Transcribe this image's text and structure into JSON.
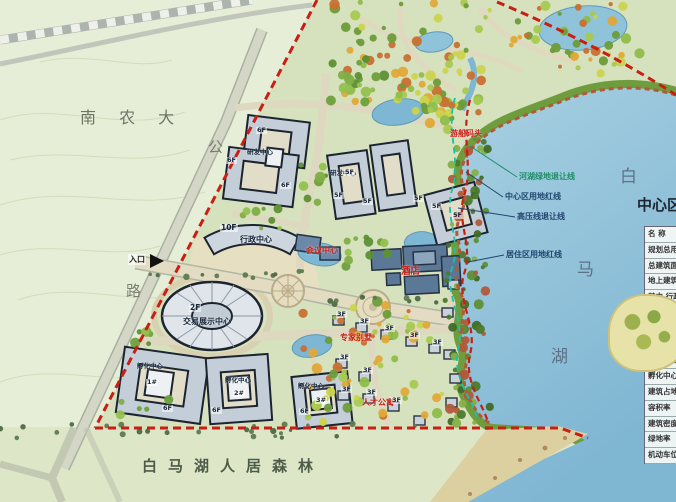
{
  "regions": {
    "campus": "南 农 大",
    "road_char_1": "公",
    "road_char_2": "路",
    "lake_char_1": "白",
    "lake_char_2": "马",
    "lake_char_3": "湖",
    "forest": "白马湖人居森林"
  },
  "boundaries": {
    "river_green_line": "河湖绿地退让线",
    "center_red_line": "中心区用地红线",
    "high_voltage_line": "高压线退让线",
    "residential_red_line": "居住区用地红线"
  },
  "entrance": "入口",
  "buildings": {
    "admin": {
      "floors": "10F",
      "name": "行政中心"
    },
    "expo": {
      "floors": "2F",
      "name": "交易展示中心"
    },
    "rd_center_a": "研发中心",
    "rd_center_b": "研发中心",
    "hotel": "酒店",
    "conference": "会议中心",
    "dock": "游船码头",
    "expert_villa": "专家别墅",
    "talent_apartment": "人才公寓",
    "inc1": {
      "name": "孵化中心",
      "no": "1#",
      "floors": "6F"
    },
    "inc2": {
      "name": "孵化中心",
      "no": "2#",
      "floors": "6F"
    },
    "inc3": {
      "name": "孵化中心",
      "no": "3#",
      "floors": "6F"
    }
  },
  "floor_marks": [
    "6F",
    "6F",
    "6F",
    "5F",
    "5F",
    "5F",
    "5F",
    "5F",
    "5F",
    "3F",
    "3F",
    "3F",
    "3F",
    "3F",
    "3F",
    "3F",
    "3F",
    "3F",
    "3F"
  ],
  "table": {
    "title": "中心区",
    "rows": [
      "名  称",
      "规划总用地",
      "总建筑面积",
      "地上建筑面积",
      "其中 行政中心",
      "交易展示中心",
      "酒店",
      "会议中心",
      "研发中心",
      "孵化中心",
      "建筑占地面积",
      "容积率",
      "建筑密度",
      "绿地率",
      "机动车位"
    ]
  },
  "colors": {
    "boundary_red": "#c81e14",
    "setback_teal": "#17c2a8",
    "lake_blue": "#8cc2da",
    "terrain_green": "#e7eed8"
  }
}
